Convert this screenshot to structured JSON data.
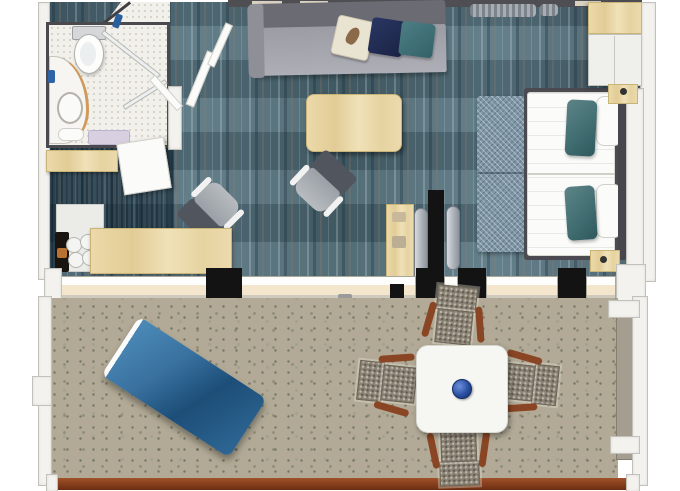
{
  "scene": {
    "kind": "3d-rendered floor plan, top-down view",
    "subject": "hotel suite with bathroom, living area, bedroom and furnished balcony",
    "visible_text": "none"
  },
  "palette": {
    "carpet_teal": "#4f6a75",
    "entry_carpet_navy": "#1c3347",
    "bathroom_floor": "#f2f0ea",
    "balcony_floor": "#b2aa96",
    "wood_light": "#e8d5a6",
    "wall_white": "#f3f2ee",
    "wall_black": "#131313",
    "sofa_gray": "#a3a3ab",
    "pillow_cream": "#e9e3d2",
    "pillow_navy": "#202a4e",
    "pillow_teal": "#3c6f75",
    "bed_duvet_white": "#fbfbf9",
    "bed_runner_blue": "#7f96a7",
    "lounger_blue": "#2d6799",
    "railing_brown": "#7c3a18",
    "wicker_gray": "#8b8375",
    "chair_arm_brown": "#8a4524",
    "bowl_blue": "#2a4fa0"
  },
  "rooms": {
    "bathroom": {
      "label": "Bathroom",
      "items": [
        "toilet",
        "curved vanity with sink",
        "walk-in shower with glass panels",
        "lavender bath mat",
        "towel"
      ]
    },
    "entry": {
      "label": "Entry hall",
      "items": [
        "open entry door",
        "open bathroom door",
        "luggage bench",
        "minibar counter",
        "coffee maker",
        "four glasses"
      ]
    },
    "living": {
      "label": "Living area",
      "items": [
        "gray sofa",
        "cream pillow with bird print",
        "navy pillow",
        "teal pillow",
        "wood coffee table",
        "two gray armchairs",
        "wood desk",
        "TV console",
        "two flat TVs"
      ]
    },
    "bedroom": {
      "label": "Bedroom",
      "items": [
        "double bed with white duvet",
        "patterned bed runner",
        "two teal pillows",
        "white pillows",
        "two wood nightstands",
        "wardrobe",
        "curtains"
      ]
    },
    "balcony": {
      "label": "Balcony",
      "items": [
        "blue sun lounger",
        "white square dining table",
        "blue centerpiece bowl",
        "four wicker chairs with wood arms",
        "dark wood railing"
      ]
    }
  },
  "labels": {
    "sofa": "Sofa",
    "coffee_table": "Coffee table",
    "armchair": "Armchair",
    "desk": "Desk",
    "tv": "Television",
    "bed": "Double bed",
    "wardrobe": "Wardrobe",
    "toilet": "Toilet",
    "vanity": "Vanity with sink",
    "lounger": "Sun lounger",
    "dining_table": "Dining table",
    "wicker_chair": "Wicker chair",
    "railing": "Balcony railing"
  }
}
